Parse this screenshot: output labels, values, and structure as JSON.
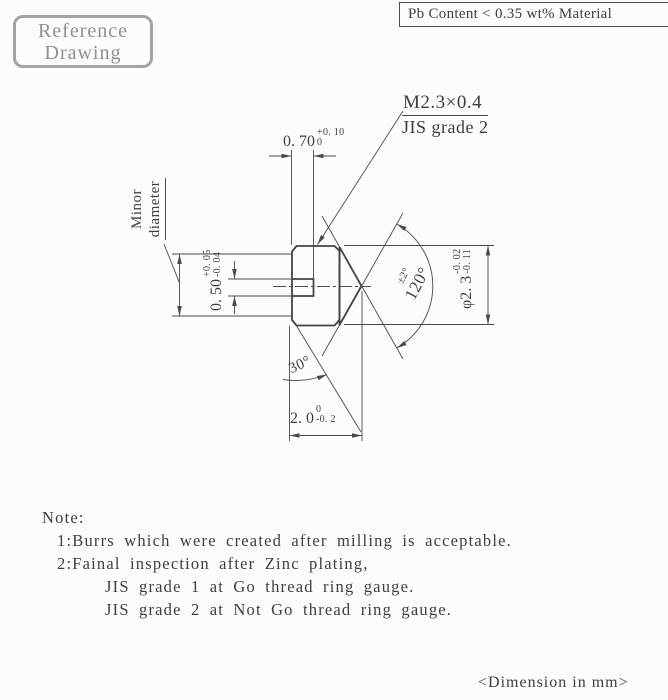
{
  "colors": {
    "line": "#4a4a4a",
    "text": "#3e3e3e",
    "stamp_border": "#a3a3a3",
    "stamp_text": "#8f8f8f",
    "background": "#fcfcfb"
  },
  "stamps": {
    "reference_line1": "Reference",
    "reference_line2": "Drawing",
    "material_note": "Pb Content < 0.35 wt% Material"
  },
  "callouts": {
    "thread_spec": "M2.3×0.4",
    "thread_grade": "JIS grade 2",
    "minor_diameter_line1": "Minor",
    "minor_diameter_line2": "diameter"
  },
  "dimensions": {
    "slot_depth": {
      "value": "0. 70",
      "upper_tol": "+0. 10",
      "lower_tol": "0"
    },
    "slot_width": {
      "value": "0. 50",
      "upper_tol": "+0. 05",
      "lower_tol": "-0. 04"
    },
    "thread_diameter": {
      "value": "φ2. 3",
      "upper_tol": "-0. 02",
      "lower_tol": "-0. 11"
    },
    "body_length": {
      "value": "2. 0",
      "upper_tol": "0",
      "lower_tol": "-0. 2"
    },
    "point_angle": {
      "tolerance": "±2°",
      "value": "120°"
    },
    "chamfer_angle": {
      "value": "30°"
    }
  },
  "notes": {
    "title": "Note:",
    "items": [
      "1:Burrs which were created after milling is acceptable.",
      "2:Fainal inspection after Zinc plating,",
      "JIS grade 1 at Go thread ring gauge.",
      "JIS grade 2 at Not Go thread ring gauge."
    ]
  },
  "footer": {
    "unit_note": "<Dimension in mm>"
  }
}
